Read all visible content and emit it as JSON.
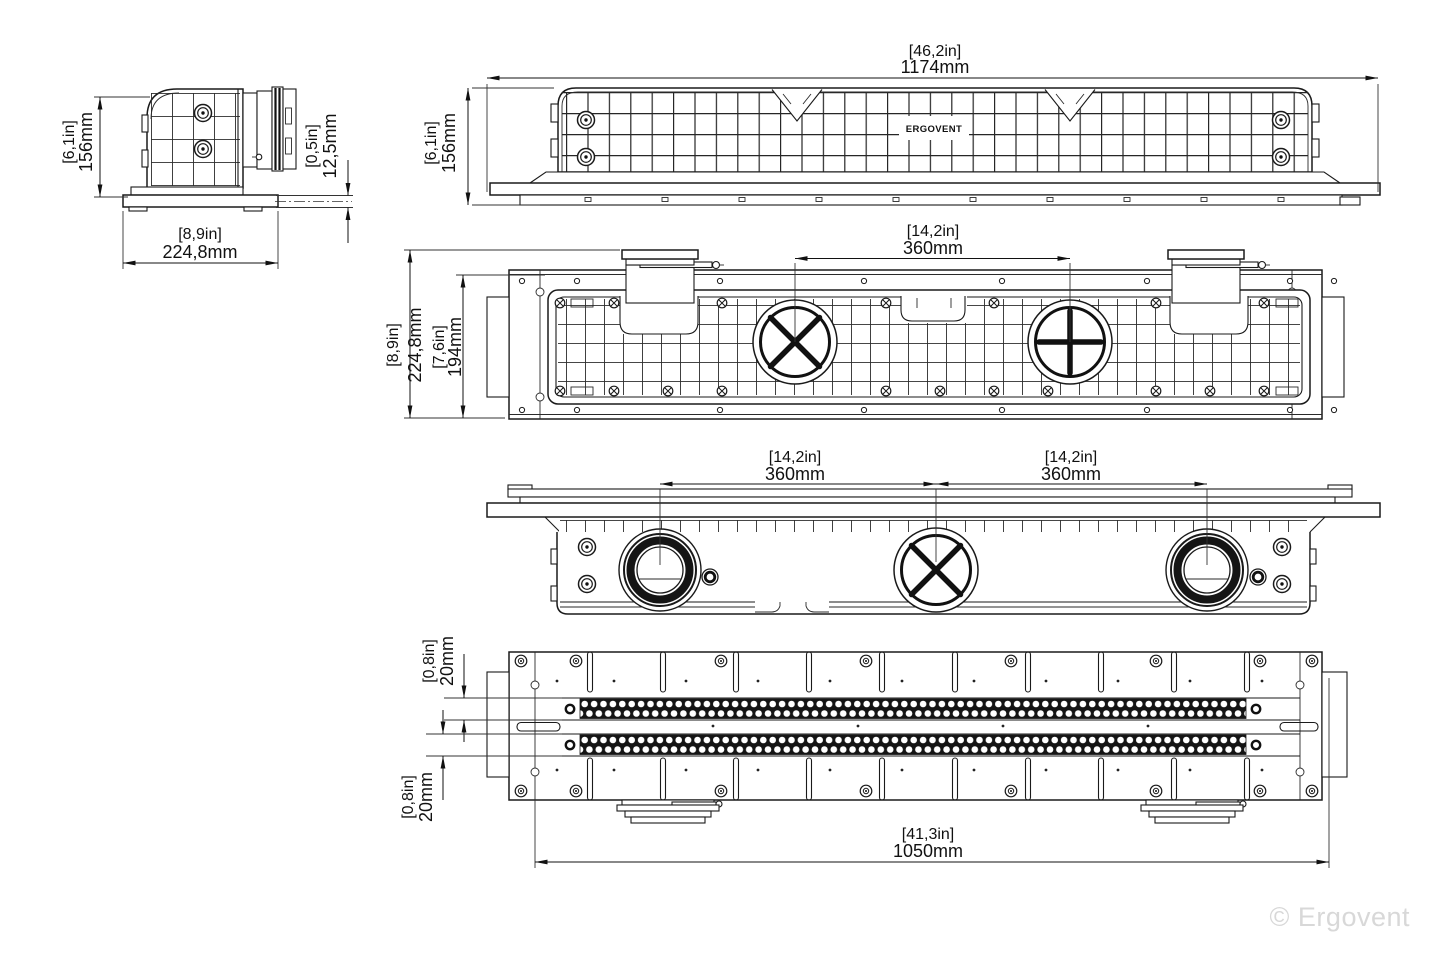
{
  "watermark": "© Ergovent",
  "brand": "ERGOVENT",
  "dims": {
    "side_height_in": "[6,1in]",
    "side_height_mm": "156mm",
    "side_lip_in": "[0,5in]",
    "side_lip_mm": "12,5mm",
    "side_depth_in": "[8,9in]",
    "side_depth_mm": "224,8mm",
    "front_width_in": "[46,2in]",
    "front_width_mm": "1174mm",
    "front_height_in": "[6,1in]",
    "front_height_mm": "156mm",
    "plan_spacing_in": "[14,2in]",
    "plan_spacing_mm": "360mm",
    "plan_depth_in": "[8,9in]",
    "plan_depth_mm": "224,8mm",
    "plan_inner_in": "[7,6in]",
    "plan_inner_mm": "194mm",
    "under_spacing_left_in": "[14,2in]",
    "under_spacing_left_mm": "360mm",
    "under_spacing_right_in": "[14,2in]",
    "under_spacing_right_mm": "360mm",
    "bottom_slot_top_in": "[0,8in]",
    "bottom_slot_top_mm": "20mm",
    "bottom_slot_bottom_in": "[0,8in]",
    "bottom_slot_bottom_mm": "20mm",
    "bottom_length_in": "[41,3in]",
    "bottom_length_mm": "1050mm"
  }
}
